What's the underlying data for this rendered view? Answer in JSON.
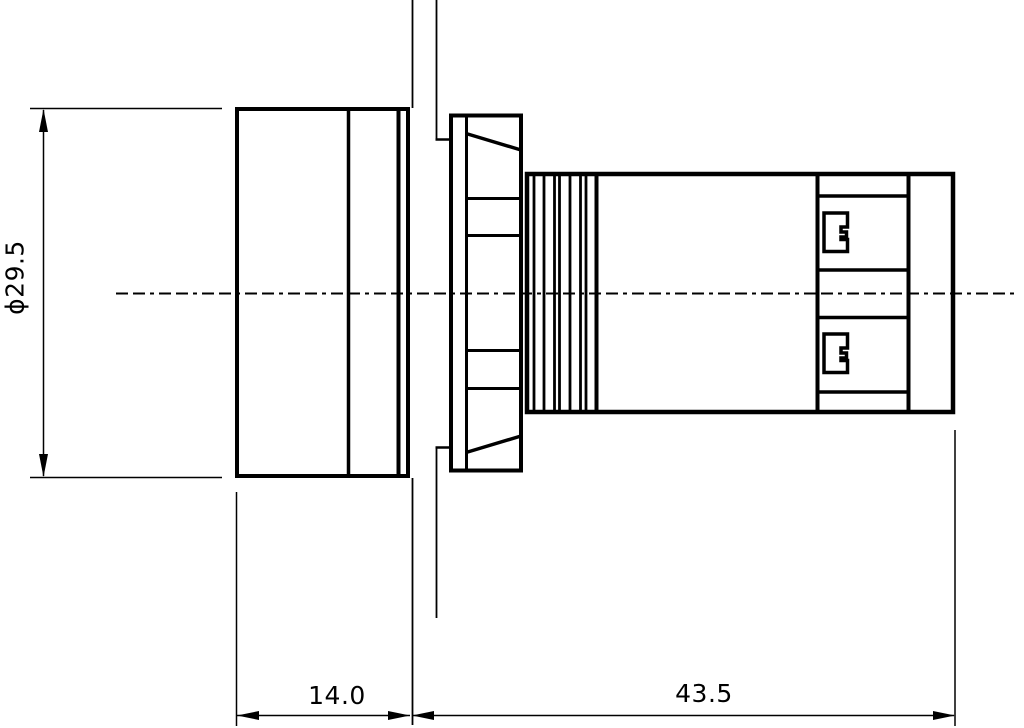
{
  "drawing": {
    "background_color": "#ffffff",
    "line_color": "#000000",
    "dimensions": {
      "diameter": {
        "label": "ϕ29.5",
        "value": 29.5
      },
      "head_width": {
        "label": "14.0",
        "value": 14.0
      },
      "body_length": {
        "label": "43.5",
        "value": 43.5
      }
    }
  }
}
